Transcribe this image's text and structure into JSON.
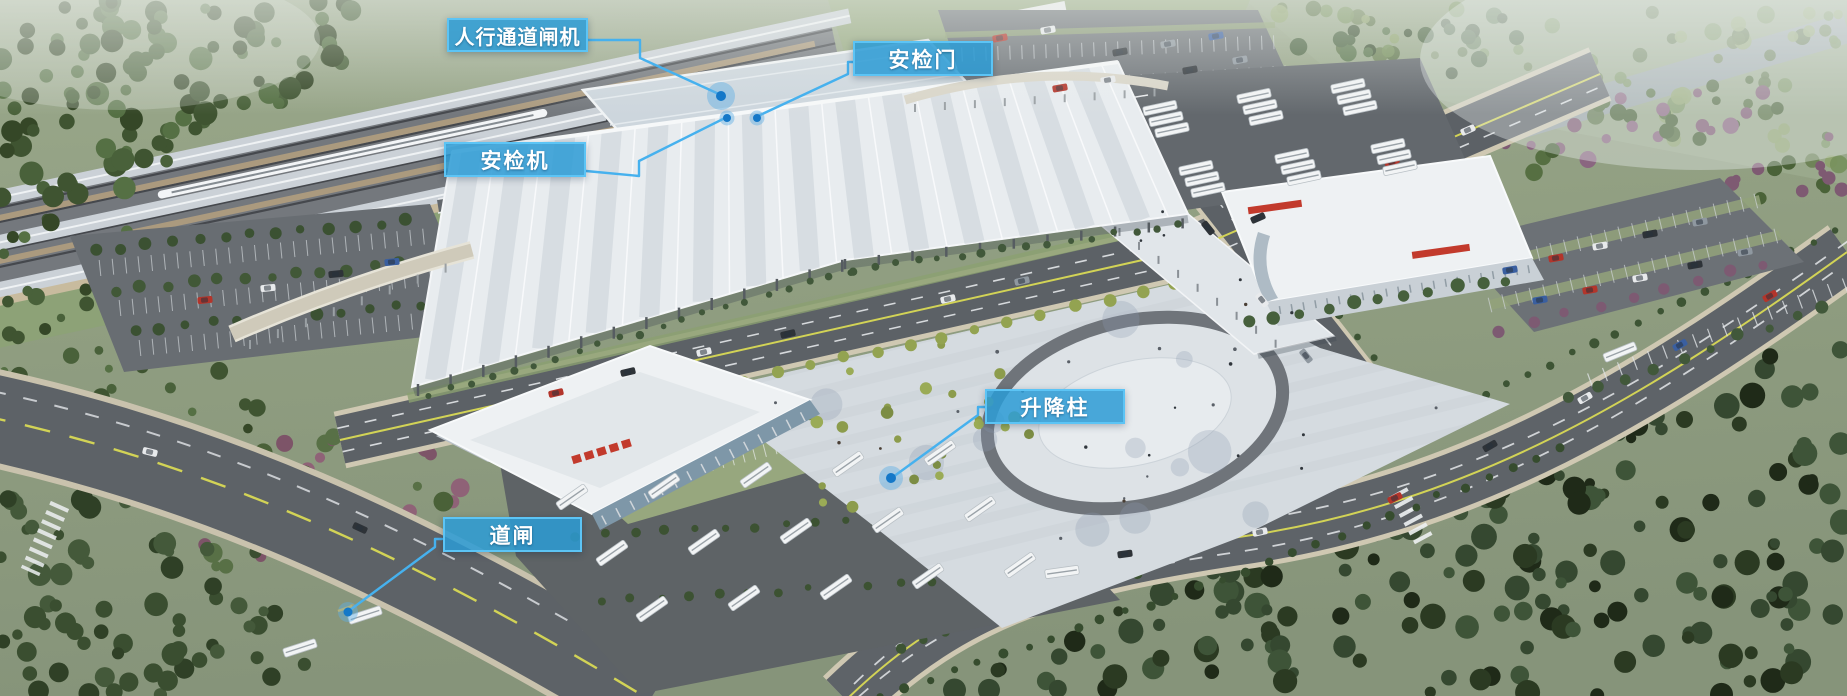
{
  "annotations": {
    "labels": [
      {
        "id": "pedestrian-channel-gate",
        "text": "人行通道闸机"
      },
      {
        "id": "security-door",
        "text": "安检门"
      },
      {
        "id": "security-scanner",
        "text": "安检机"
      },
      {
        "id": "lifting-bollard",
        "text": "升降柱"
      },
      {
        "id": "barrier-gate",
        "text": "道闸"
      }
    ],
    "colors": {
      "label_bg": "#2b9bd5",
      "label_border": "#5cc4f5",
      "label_text": "#ffffff",
      "leader_line": "#46b1ee",
      "marker_dot": "#1478c8",
      "marker_halo": "rgba(96,175,228,0.45)"
    }
  }
}
